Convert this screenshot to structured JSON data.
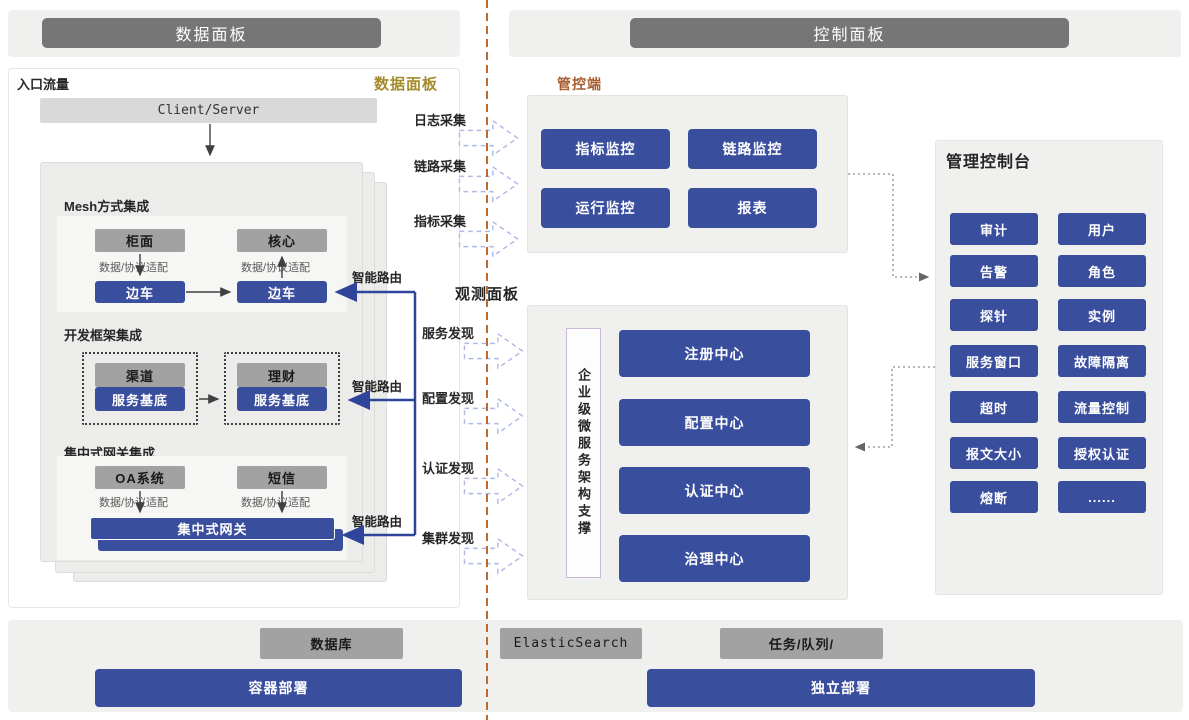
{
  "headers": {
    "data_panel": "数据面板",
    "control_panel": "控制面板"
  },
  "data_plane": {
    "corner_label": "入口流量",
    "panel_label": "数据面板",
    "client_server": "Client/Server",
    "adapter_label": "数据/协议适配",
    "smart_route_label": "智能路由",
    "mesh": {
      "title": "Mesh方式集成",
      "top_left": "柜面",
      "top_right": "核心",
      "sidecar_left": "边车",
      "sidecar_right": "边车"
    },
    "framework": {
      "title": "开发框架集成",
      "left_top": "渠道",
      "right_top": "理财",
      "base_left": "服务基底",
      "base_right": "服务基底"
    },
    "gateway": {
      "title": "集中式网关集成",
      "left": "OA系统",
      "right": "短信",
      "bar": "集中式网关"
    }
  },
  "flows": {
    "collect": [
      "日志采集",
      "链路采集",
      "指标采集"
    ],
    "observe_title": "观测面板",
    "discover": [
      "服务发现",
      "配置发现",
      "认证发现",
      "集群发现"
    ]
  },
  "control_plane": {
    "monitor_label": "管控端",
    "monitor_buttons": [
      "指标监控",
      "链路监控",
      "运行监控",
      "报表"
    ],
    "support_vertical": "企业级微服务架构支撑",
    "centers": [
      "注册中心",
      "配置中心",
      "认证中心",
      "治理中心"
    ],
    "console": {
      "title": "管理控制台",
      "buttons": [
        "审计",
        "用户",
        "告警",
        "角色",
        "探针",
        "实例",
        "服务窗口",
        "故障隔离",
        "超时",
        "流量控制",
        "报文大小",
        "授权认证",
        "熔断",
        "......"
      ]
    }
  },
  "infrastructure": {
    "database": "数据库",
    "elasticsearch": "ElasticSearch",
    "task_queue": "任务/队列/",
    "container_deploy": "容器部署",
    "standalone_deploy": "独立部署"
  },
  "colors": {
    "accent_blue": "#3a4e9e",
    "bar_gray": "#a2a2a2",
    "header_gray": "#767676",
    "gold_label": "#a68b2c",
    "orange_label": "#a85c30",
    "divider_orange": "#c0692f",
    "flow_arrow_stroke": "#b0b9e6"
  }
}
